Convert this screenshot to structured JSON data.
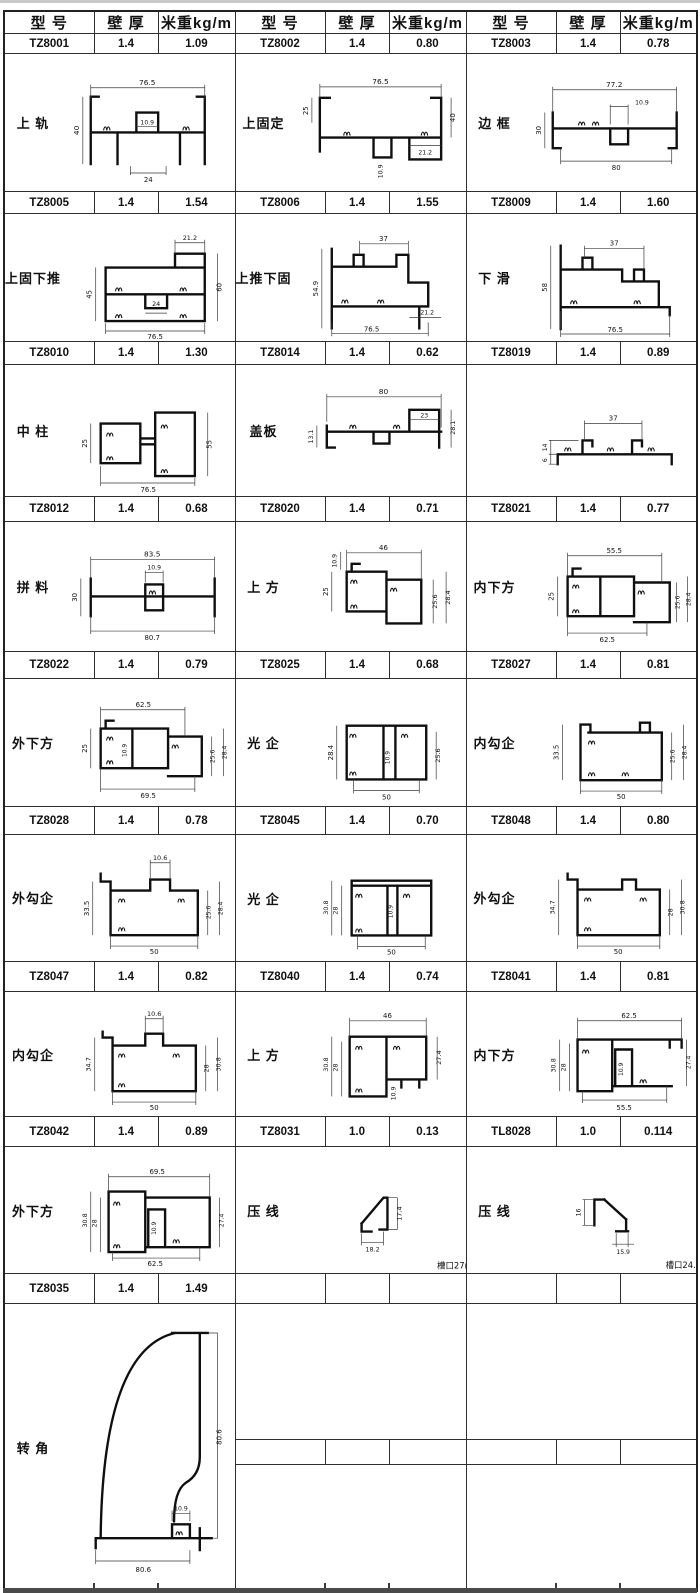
{
  "header": {
    "model": "型 号",
    "thickness": "壁 厚",
    "weight": "米重kg/m"
  },
  "rows": [
    [
      {
        "model": "TZ8001",
        "thickness": "1.4",
        "weight": "1.09",
        "name": "上 轨",
        "dims": [
          "76.5",
          "40",
          "10.9",
          "24"
        ]
      },
      {
        "model": "TZ8002",
        "thickness": "1.4",
        "weight": "0.80",
        "name": "上固定",
        "dims": [
          "76.5",
          "25",
          "40",
          "21.2",
          "10.9"
        ]
      },
      {
        "model": "TZ8003",
        "thickness": "1.4",
        "weight": "0.78",
        "name": "边 框",
        "dims": [
          "77.2",
          "10.9",
          "30",
          "80"
        ]
      }
    ],
    [
      {
        "model": "TZ8005",
        "thickness": "1.4",
        "weight": "1.54",
        "name": "上固下推",
        "dims": [
          "21.2",
          "45",
          "60",
          "24",
          "76.5"
        ]
      },
      {
        "model": "TZ8006",
        "thickness": "1.4",
        "weight": "1.55",
        "name": "上推下固",
        "dims": [
          "37",
          "54.9",
          "21.2",
          "76.5"
        ]
      },
      {
        "model": "TZ8009",
        "thickness": "1.4",
        "weight": "1.60",
        "name": "下 滑",
        "dims": [
          "37",
          "58",
          "76.5"
        ]
      }
    ],
    [
      {
        "model": "TZ8010",
        "thickness": "1.4",
        "weight": "1.30",
        "name": "中 柱",
        "dims": [
          "25",
          "55",
          "76.5"
        ]
      },
      {
        "model": "TZ8014",
        "thickness": "1.4",
        "weight": "0.62",
        "name": "盖板",
        "dims": [
          "80",
          "23",
          "28.1",
          "13.1"
        ]
      },
      {
        "model": "TZ8019",
        "thickness": "1.4",
        "weight": "0.89",
        "name": "",
        "dims": [
          "37",
          "14",
          "6"
        ]
      }
    ],
    [
      {
        "model": "TZ8012",
        "thickness": "1.4",
        "weight": "0.68",
        "name": "拼 料",
        "dims": [
          "83.5",
          "10.9",
          "30",
          "80.7"
        ]
      },
      {
        "model": "TZ8020",
        "thickness": "1.4",
        "weight": "0.71",
        "name": "上 方",
        "dims": [
          "46",
          "10.9",
          "25",
          "25.6",
          "28.4"
        ]
      },
      {
        "model": "TZ8021",
        "thickness": "1.4",
        "weight": "0.77",
        "name": "内下方",
        "dims": [
          "55.5",
          "25",
          "25.6",
          "28.4",
          "62.5"
        ]
      }
    ],
    [
      {
        "model": "TZ8022",
        "thickness": "1.4",
        "weight": "0.79",
        "name": "外下方",
        "dims": [
          "62.5",
          "25",
          "10.9",
          "25.6",
          "28.4",
          "69.5"
        ]
      },
      {
        "model": "TZ8025",
        "thickness": "1.4",
        "weight": "0.68",
        "name": "光 企",
        "dims": [
          "28.4",
          "10.9",
          "25.6",
          "50"
        ]
      },
      {
        "model": "TZ8027",
        "thickness": "1.4",
        "weight": "0.81",
        "name": "内勾企",
        "dims": [
          "33.5",
          "25.6",
          "28.4",
          "50"
        ]
      }
    ],
    [
      {
        "model": "TZ8028",
        "thickness": "1.4",
        "weight": "0.78",
        "name": "外勾企",
        "dims": [
          "10.6",
          "33.5",
          "25.6",
          "28.4",
          "50"
        ]
      },
      {
        "model": "TZ8045",
        "thickness": "1.4",
        "weight": "0.70",
        "name": "光 企",
        "dims": [
          "30.8",
          "28",
          "10.9",
          "50"
        ]
      },
      {
        "model": "TZ8048",
        "thickness": "1.4",
        "weight": "0.80",
        "name": "外勾企",
        "dims": [
          "34.7",
          "28",
          "30.8",
          "50"
        ]
      }
    ],
    [
      {
        "model": "TZ8047",
        "thickness": "1.4",
        "weight": "0.82",
        "name": "内勾企",
        "dims": [
          "10.6",
          "34.7",
          "28",
          "30.8",
          "50"
        ]
      },
      {
        "model": "TZ8040",
        "thickness": "1.4",
        "weight": "0.74",
        "name": "上 方",
        "dims": [
          "46",
          "30.8",
          "28",
          "27.4",
          "10.9"
        ]
      },
      {
        "model": "TZ8041",
        "thickness": "1.4",
        "weight": "0.81",
        "name": "内下方",
        "dims": [
          "62.5",
          "30.8",
          "28",
          "10.9",
          "27.4",
          "55.5"
        ]
      }
    ],
    [
      {
        "model": "TZ8042",
        "thickness": "1.4",
        "weight": "0.89",
        "name": "外下方",
        "dims": [
          "69.5",
          "30.8",
          "28",
          "10.9",
          "27.4",
          "62.5"
        ]
      },
      {
        "model": "TZ8031",
        "thickness": "1.0",
        "weight": "0.13",
        "name": "压 线",
        "dims": [
          "17.4",
          "18.2"
        ],
        "note": "槽口27mm"
      },
      {
        "model": "TL8028",
        "thickness": "1.0",
        "weight": "0.114",
        "name": "压 线",
        "dims": [
          "16",
          "15.9"
        ],
        "note": "槽口24.4mm"
      }
    ],
    [
      {
        "model": "TZ8035",
        "thickness": "1.4",
        "weight": "1.49",
        "name": "转 角",
        "dims": [
          "80.6",
          "10.9",
          "80.6"
        ]
      }
    ]
  ]
}
